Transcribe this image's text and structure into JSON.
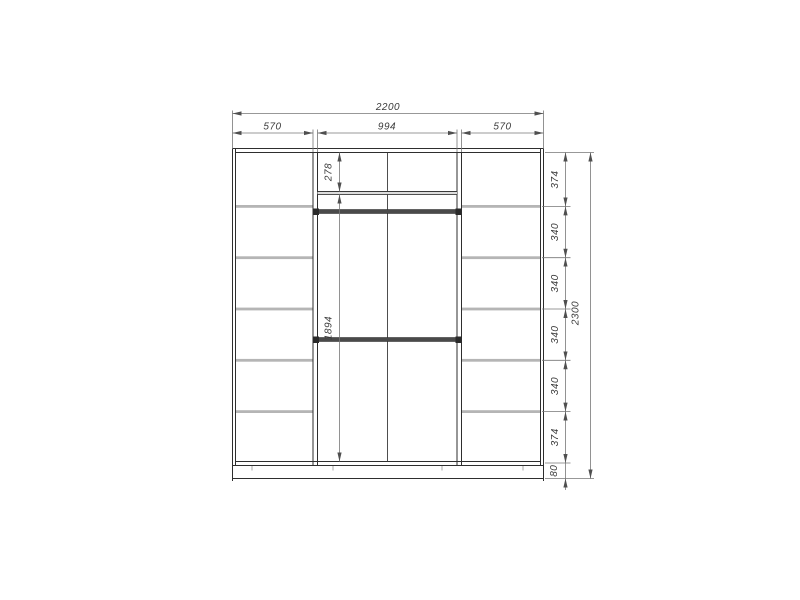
{
  "drawing": {
    "width": {
      "total": "2200",
      "left_section": "570",
      "middle_section": "994",
      "right_section": "570"
    },
    "height": {
      "total": "2300",
      "segments": [
        "374",
        "340",
        "340",
        "340",
        "340",
        "374",
        "80"
      ]
    },
    "interior": {
      "top_shelf_height": "278",
      "hanging_height": "1894"
    }
  }
}
